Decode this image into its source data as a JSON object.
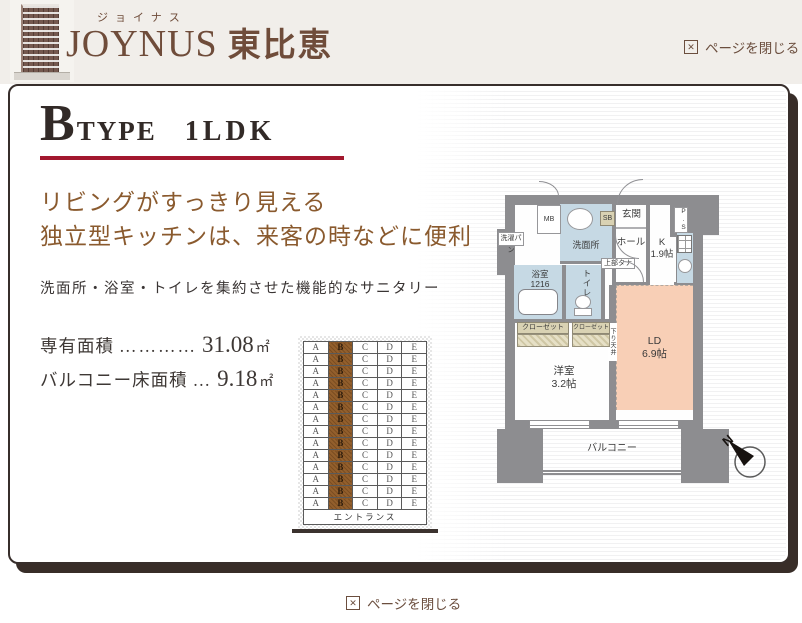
{
  "header": {
    "furigana": "ジョイナス",
    "title_en": "JOYNUS",
    "title_ja": "東比恵",
    "close_label": "ページを閉じる"
  },
  "footer": {
    "close_label": "ページを閉じる"
  },
  "icons": {
    "close_x": "✕"
  },
  "plan": {
    "type_letter": "B",
    "type_word": "TYPE",
    "layout_label": "1LDK",
    "catch_line1": "リビングがすっきり見える",
    "catch_line2": "独立型キッチンは、来客の時などに便利",
    "subcopy": "洗面所・浴室・トイレを集約させた機能的なサニタリー",
    "specs": [
      {
        "label": "専有面積",
        "dots": "…………",
        "value": "31.08",
        "unit": "㎡"
      },
      {
        "label": "バルコニー床面積",
        "dots": "…",
        "value": "9.18",
        "unit": "㎡"
      }
    ]
  },
  "unit_grid": {
    "columns": [
      "A",
      "B",
      "C",
      "D",
      "E"
    ],
    "floors": 14,
    "highlight_column": "B",
    "entrance_label": "エントランス"
  },
  "floorplan": {
    "mb": "MB",
    "laundry_pan": "洗濯パン",
    "washroom": "洗面所",
    "shoe_box": "SB",
    "entrance": "玄関",
    "hall": "ホール",
    "kitchen_name": "K",
    "kitchen_size": "1.9帖",
    "pipe_space": "P.S",
    "bathroom_name": "浴室",
    "bathroom_size": "1216",
    "toilet": "トイレ",
    "upper_shelf": "上部タナ",
    "closet_left": "クローゼット",
    "closet_right": "クローゼット",
    "lowered_ceiling": "下り天井",
    "ld_name": "LD",
    "ld_size": "6.9帖",
    "bedroom_name": "洋室",
    "bedroom_size": "3.2帖",
    "balcony": "バルコニー",
    "compass_north": "N"
  },
  "colors": {
    "accent_red": "#a2182e",
    "brand_brown": "#6f4c3a",
    "copy_brown": "#8a5a2e",
    "wall_gray": "#8d8d90",
    "wet_blue": "#c6d9e4",
    "ld_peach": "#f8cfb6",
    "closet_tan": "#d9d2b3",
    "unit_highlight": "#935f2c"
  }
}
